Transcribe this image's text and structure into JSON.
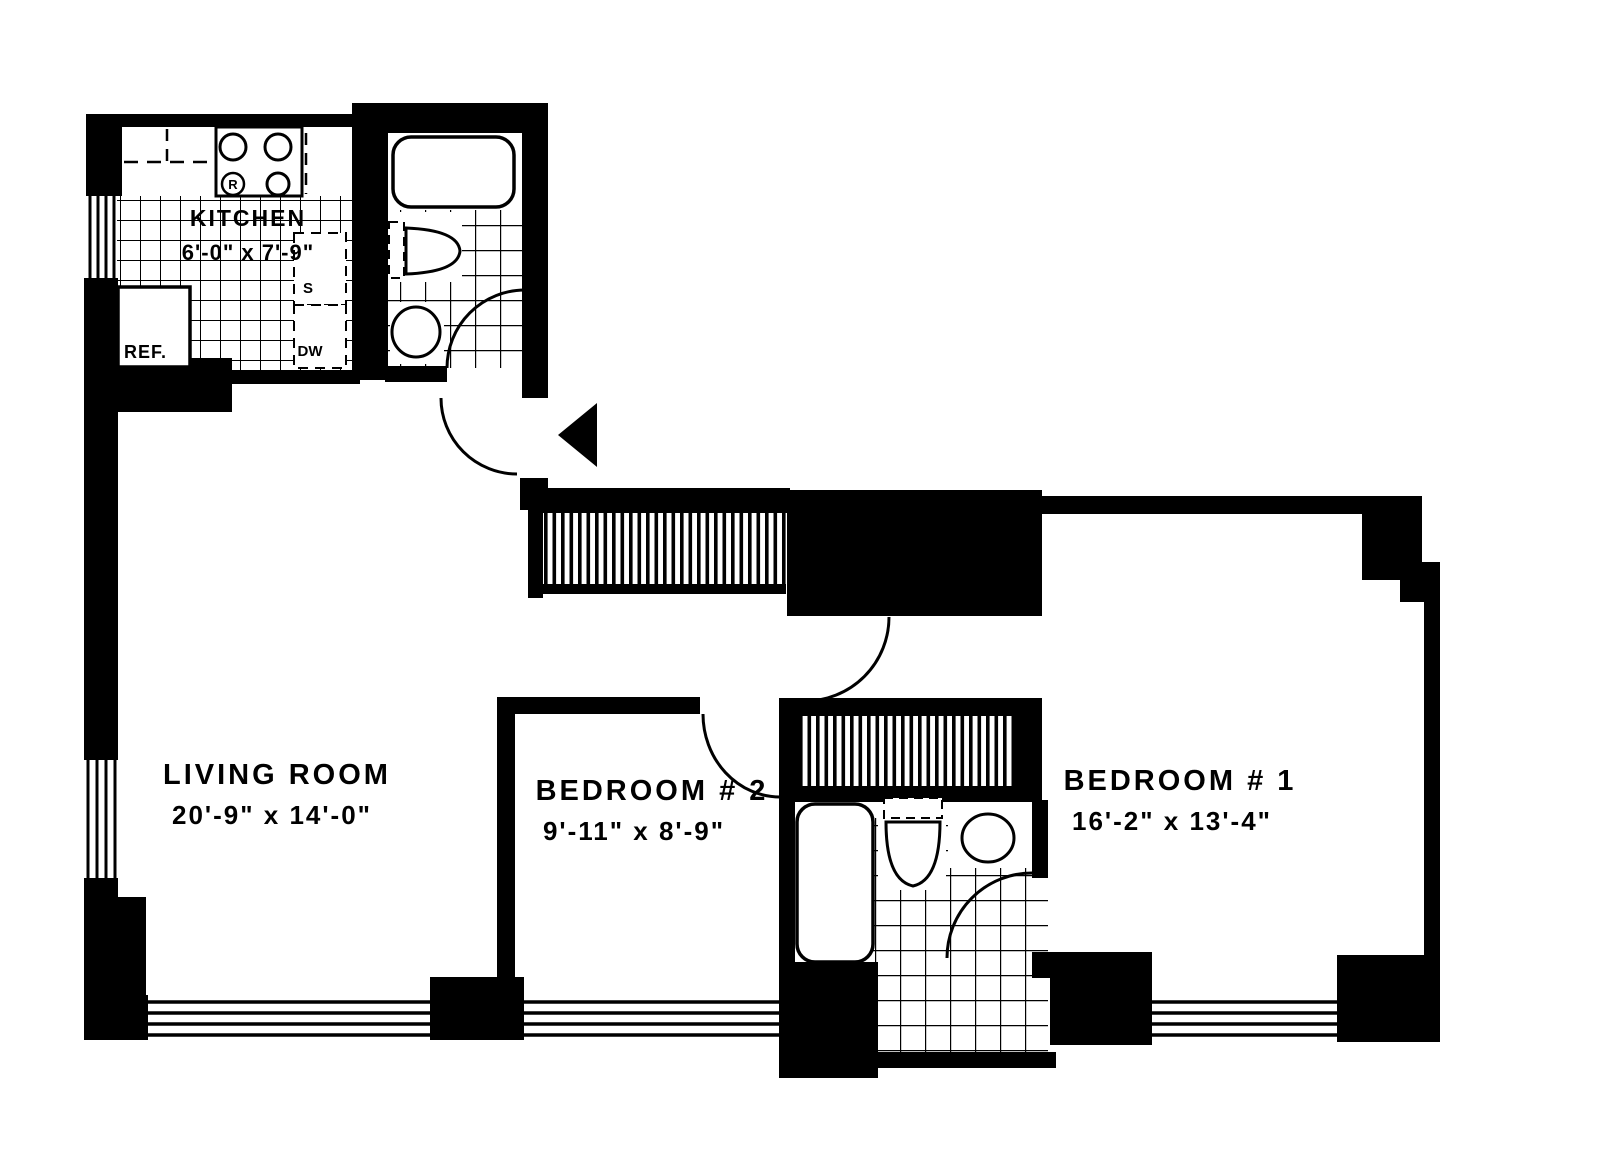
{
  "colors": {
    "ink": "#000000",
    "paper": "#ffffff"
  },
  "rooms": {
    "kitchen": {
      "name": "KITCHEN",
      "dims": "6'-0\" x 7'-9\""
    },
    "living_room": {
      "name": "LIVING ROOM",
      "dims": "20'-9\" x 14'-0\""
    },
    "bedroom_2": {
      "name": "BEDROOM # 2",
      "dims": "9'-11\" x 8'-9\""
    },
    "bedroom_1": {
      "name": "BEDROOM # 1",
      "dims": "16'-2\" x 13'-4\""
    }
  },
  "kitchen_fixtures": {
    "refrigerator_label": "REF.",
    "sink_label": "S",
    "dishwasher_label": "DW",
    "range_label": "R"
  }
}
